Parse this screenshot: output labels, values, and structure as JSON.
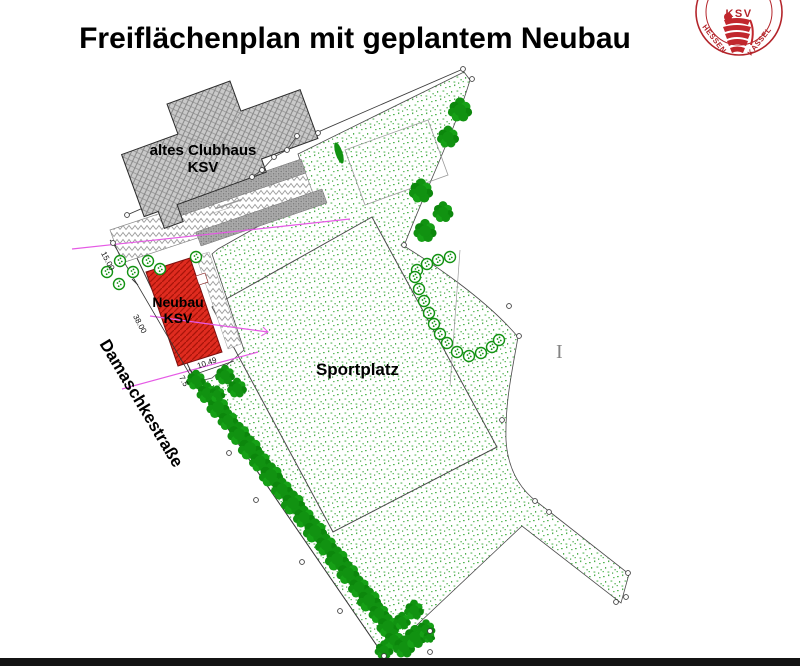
{
  "title": "Freiflächenplan mit geplantem Neubau",
  "logo": {
    "top_text": "KSV",
    "left_text": "HESSEN",
    "right_text": "KASSEL"
  },
  "plan": {
    "labels": {
      "old_clubhouse_line1": "altes Clubhaus",
      "old_clubhouse_line2": "KSV",
      "new_building_line1": "Neubau",
      "new_building_line2": "KSV",
      "sports_field": "Sportplatz",
      "street": "Damaschkestraße",
      "cursor_artifact": "I"
    },
    "dimensions": {
      "street_segment_1": "15.00",
      "street_segment_2": "38.00",
      "building_offset": "10.49",
      "street_width": "7.5"
    },
    "colors": {
      "new_building_red": "#df2b1f",
      "new_building_hatch": "#a81409",
      "vegetation_green": "#119211",
      "stipple_green": "#55b755",
      "building_gray": "#c9c9c9",
      "dimension_magenta": "#e55ae5",
      "logo_red": "#b3242a",
      "boundary_gray": "#3c3c3c"
    }
  }
}
